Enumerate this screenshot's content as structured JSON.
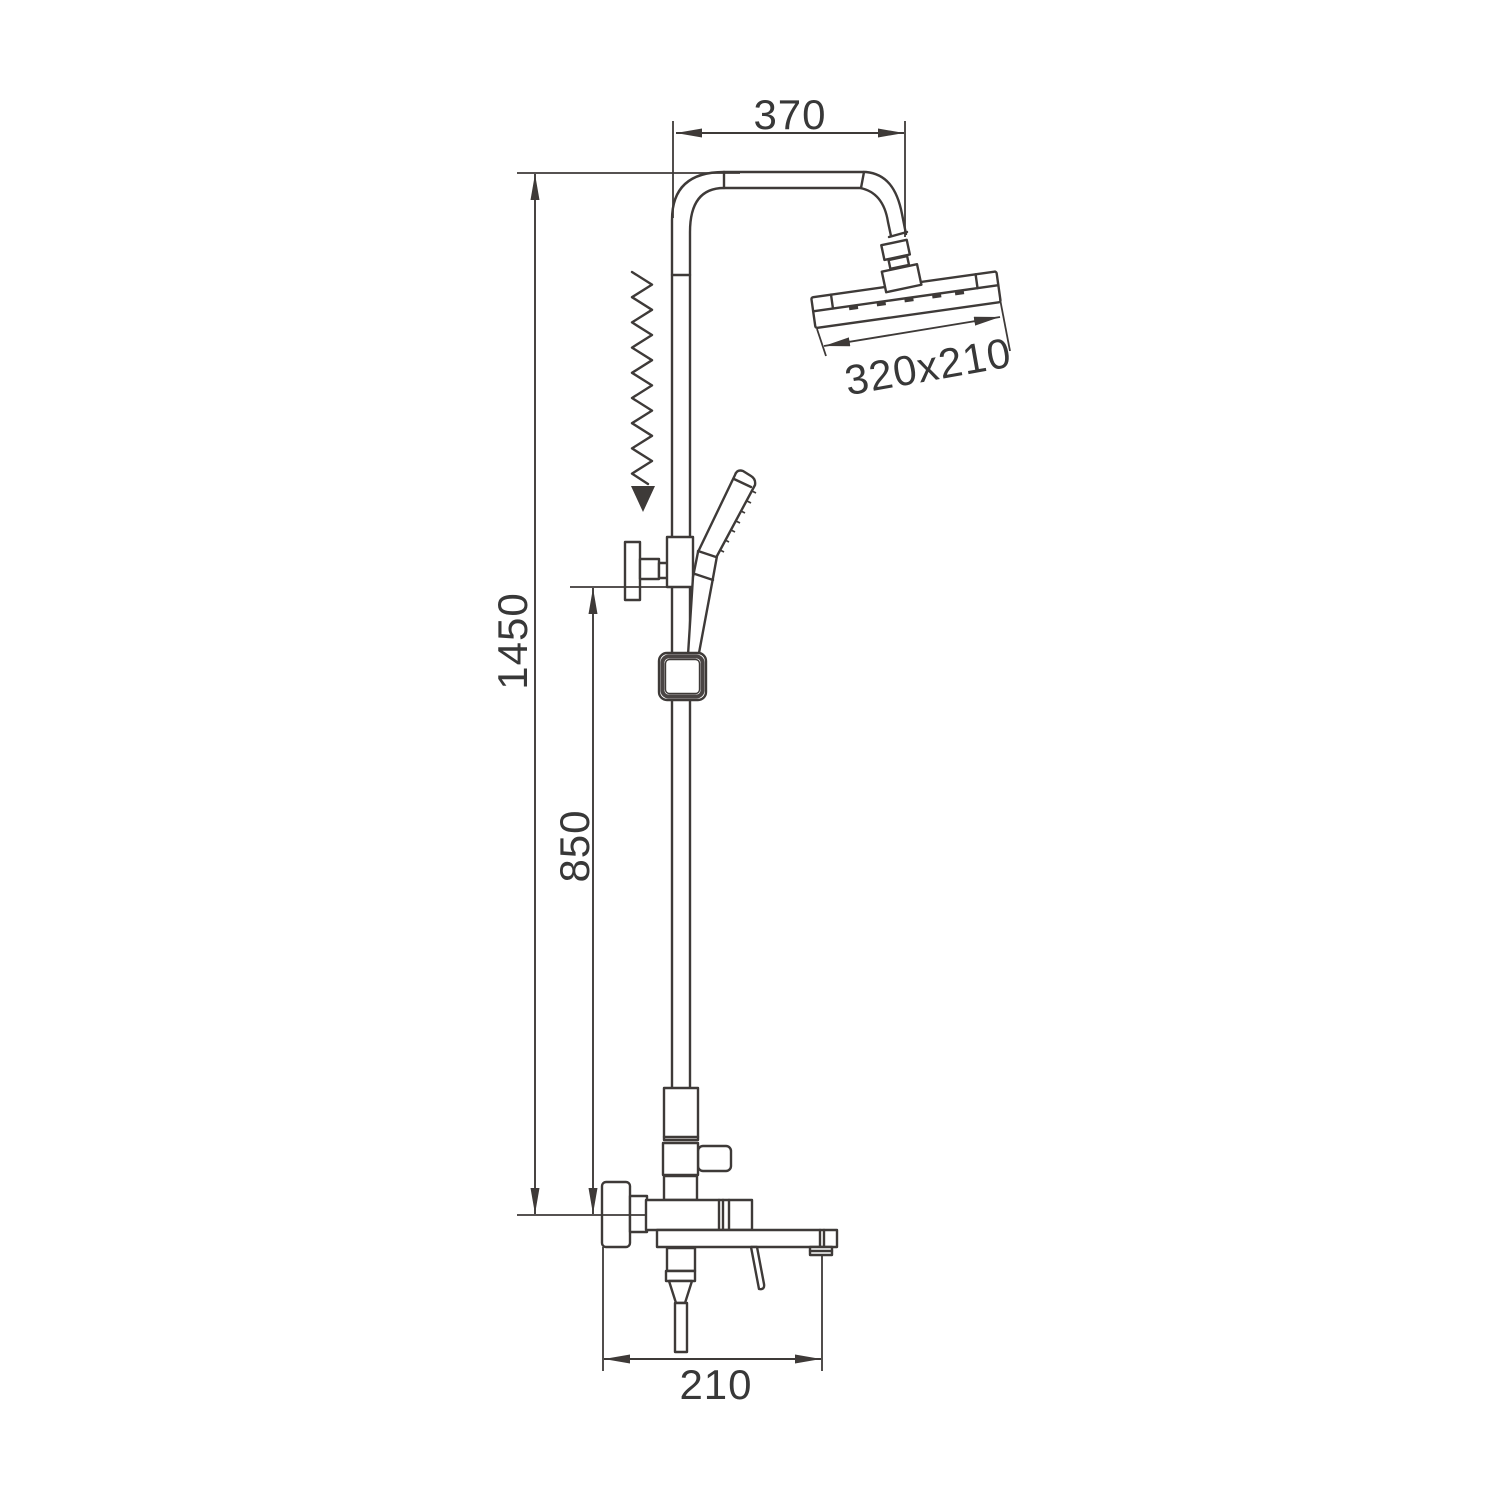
{
  "document": {
    "type": "technical dimension drawing",
    "subject": "shower column set with overhead rain shower, hand shower, riser pipe and bath mixer spout",
    "background_color": "#ffffff",
    "line_color": "#3e3a38",
    "text_color": "#383838"
  },
  "dimensions": {
    "arm_width": "370",
    "head_size": "320x210",
    "overall_height": "1450",
    "riser_height": "850",
    "spout_width": "210"
  }
}
